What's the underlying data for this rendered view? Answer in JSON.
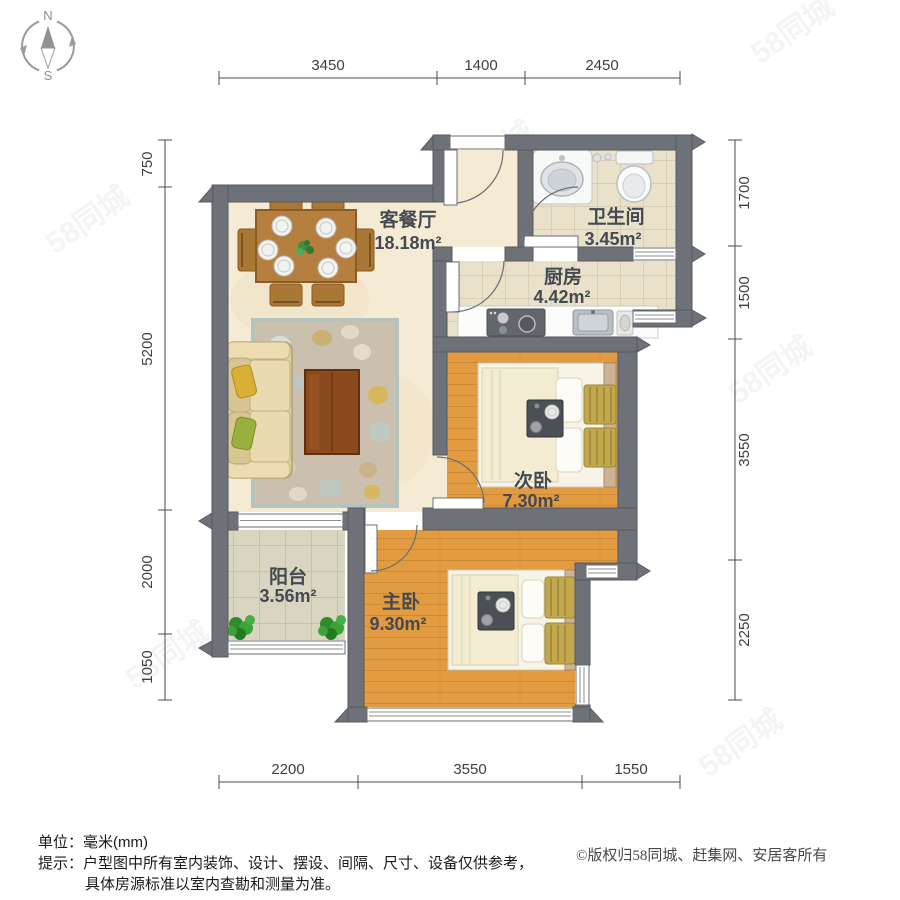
{
  "compass": {
    "north": "N",
    "south": "S"
  },
  "dimensions": {
    "top": [
      "3450",
      "1400",
      "2450"
    ],
    "left": [
      "750",
      "5200",
      "2000",
      "1050"
    ],
    "right": [
      "1700",
      "1500",
      "3550",
      "2250"
    ],
    "bottom": [
      "2200",
      "3550",
      "1550"
    ]
  },
  "rooms": {
    "living": {
      "name": "客餐厅",
      "area": "18.18m²"
    },
    "bathroom": {
      "name": "卫生间",
      "area": "3.45m²"
    },
    "kitchen": {
      "name": "厨房",
      "area": "4.42m²"
    },
    "bedroom_second": {
      "name": "次卧",
      "area": "7.30m²"
    },
    "bedroom_master": {
      "name": "主卧",
      "area": "9.30m²"
    },
    "balcony": {
      "name": "阳台",
      "area": "3.56m²"
    }
  },
  "footer": {
    "unit_label": "单位：",
    "unit_value": "毫米(mm)",
    "tip_label": "提示：",
    "tip_line1": "户型图中所有室内装饰、设计、摆设、间隔、尺寸、设备仅供参考，",
    "tip_line2": "具体房源标准以室内查勘和测量为准。",
    "copyright": "©版权归58同城、赶集网、安居客所有"
  },
  "watermark": {
    "text": "58同城"
  },
  "colors": {
    "wall": "#6e7177",
    "wall_edge": "#575a60",
    "living_floor": "#f5ead3",
    "tile_floor": "#e9e1ca",
    "balcony_floor": "#d8d5c0",
    "wood_floor": "#e29b41",
    "table_brown": "#b5803f",
    "sofa_beige": "#e3d2a2",
    "quilt_gold": "#c3a94e",
    "plant_green": "#2e8b2e",
    "label_gray": "#454a52"
  }
}
